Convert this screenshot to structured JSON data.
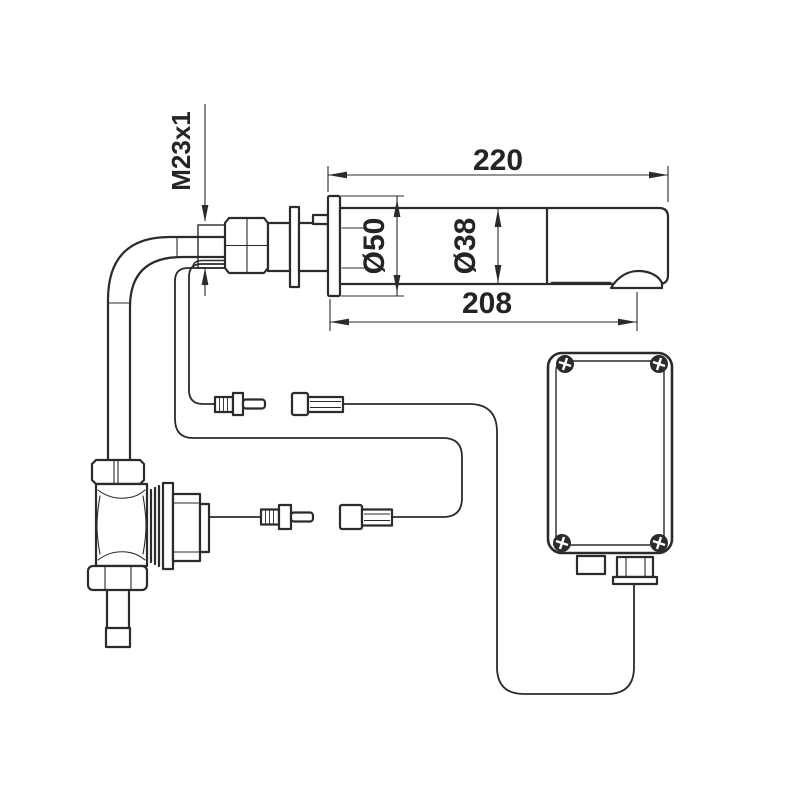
{
  "drawing": {
    "type": "technical-installation-drawing",
    "subject": "wall-mounted sensor spout with solenoid valve and control box",
    "colors": {
      "background": "#ffffff",
      "line": "#2b2b2b",
      "text": "#242424"
    },
    "labels": {
      "thread_size": "M23x1",
      "overall_length": "220",
      "flange_diameter": "Ø50",
      "spout_diameter": "Ø38",
      "projection_length": "208"
    }
  }
}
